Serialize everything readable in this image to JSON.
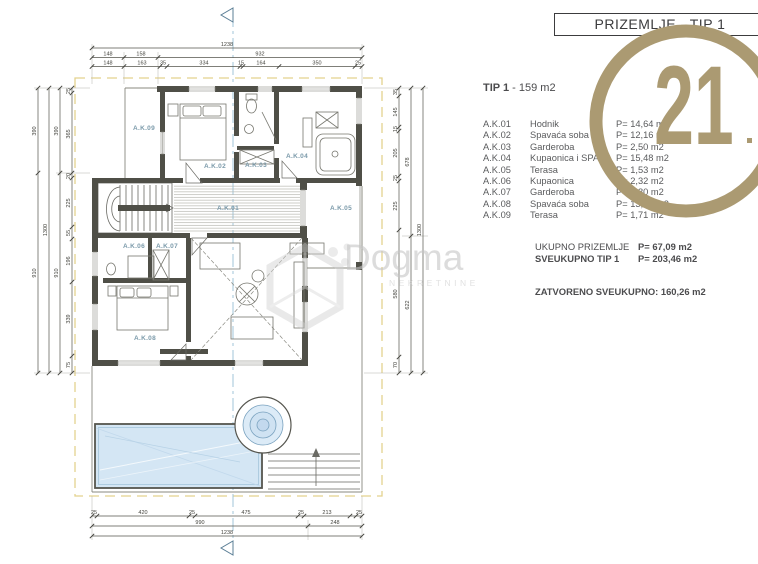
{
  "title_block": {
    "title": "PRIZEMLJE - TIP 1"
  },
  "logo": {
    "text": "21",
    "mark": ".",
    "color": "#ab9a72",
    "name": "century-21-seal"
  },
  "watermark": {
    "name": "Dogma",
    "tagline": "NEKRETNINE"
  },
  "summary": {
    "tip_bold": "TIP 1",
    "tip_rest": " - 159 m2",
    "rows": [
      {
        "code": "A.K.01",
        "room": "Hodnik",
        "area": "P= 14,64 m2"
      },
      {
        "code": "A.K.02",
        "room": "Spavaća soba",
        "area": "P= 12,16 m2"
      },
      {
        "code": "A.K.03",
        "room": "Garderoba",
        "area": "P= 2,50 m2"
      },
      {
        "code": "A.K.04",
        "room": "Kupaonica i SPA",
        "area": "P= 15,48 m2"
      },
      {
        "code": "A.K.05",
        "room": "Terasa",
        "area": "P= 1,53 m2"
      },
      {
        "code": "A.K.06",
        "room": "Kupaonica",
        "area": "P= 2,32 m2"
      },
      {
        "code": "A.K.07",
        "room": "Garderoba",
        "area": "P= 2,80 m2"
      },
      {
        "code": "A.K.08",
        "room": "Spavaća soba",
        "area": "P= 13,97 m2"
      },
      {
        "code": "A.K.09",
        "room": "Terasa",
        "area": "P= 1,71 m2"
      }
    ],
    "totals": [
      {
        "label": "UKUPNO PRIZEMLJE",
        "value": "P= 67,09 m2"
      },
      {
        "label": "SVEUKUPNO TIP 1",
        "value": "P= 203,46 m2"
      }
    ],
    "closed_total": "ZATVORENO SVEUKUPNO:  160,26 m2"
  },
  "plan": {
    "rooms": {
      "ak01": "A.K.01",
      "ak02": "A.K.02",
      "ak03": "A.K.03",
      "ak04": "A.K.04",
      "ak05": "A.K.05",
      "ak06": "A.K.06",
      "ak07": "A.K.07",
      "ak08": "A.K.08",
      "ak09": "A.K.09"
    },
    "dims": {
      "top_total": "1238",
      "top_row2": [
        "148",
        "158",
        "932"
      ],
      "top_row3": [
        "148",
        "163",
        "35",
        "334",
        "15",
        "164",
        "350",
        "25"
      ],
      "bottom_row1": [
        "25",
        "420",
        "25",
        "475",
        "25",
        "213",
        "25"
      ],
      "bottom_row2": [
        "990",
        "248"
      ],
      "bottom_total": "1238",
      "left_outer": [
        "390",
        "910"
      ],
      "left_mid": [
        "390",
        "910"
      ],
      "left_total": "1300",
      "left_inner": [
        "25",
        "365",
        "20",
        "225",
        "55",
        "196",
        "339",
        "75"
      ],
      "right_inner": [
        "35",
        "145",
        "15",
        "205",
        "25",
        "225",
        "580",
        "70"
      ],
      "right_mid": [
        "678",
        "622"
      ],
      "right_total": "1300"
    }
  }
}
